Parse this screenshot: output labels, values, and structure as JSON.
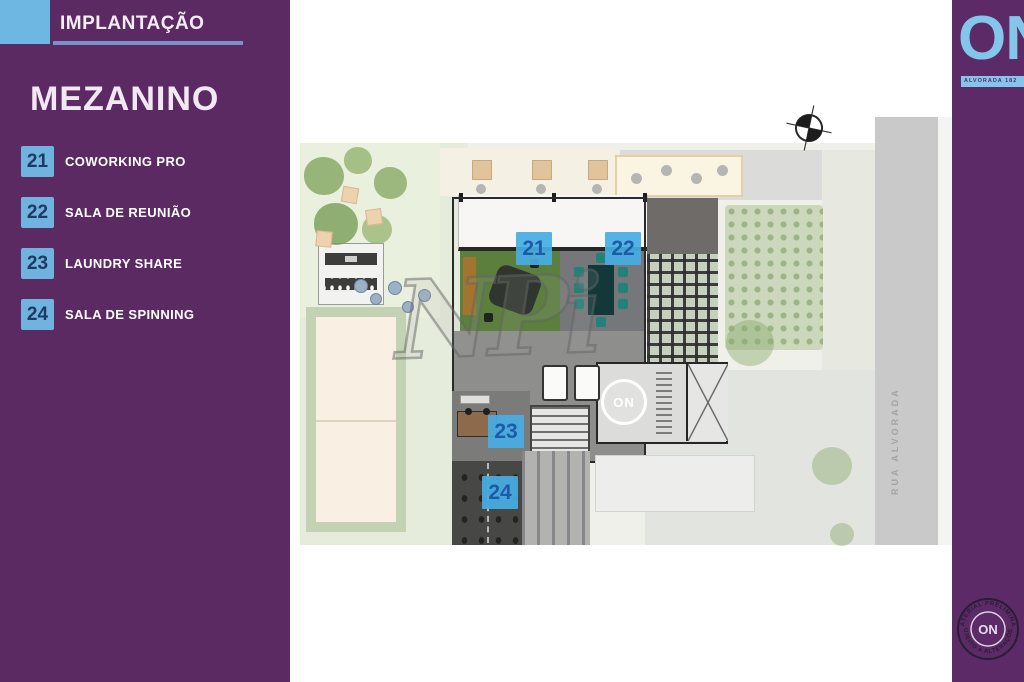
{
  "slide": {
    "header_tag": "IMPLANTAÇÃO",
    "title": "MEZANINO"
  },
  "legend": {
    "items": [
      {
        "num": "21",
        "label": "COWORKING PRO"
      },
      {
        "num": "22",
        "label": "SALA DE REUNIÃO"
      },
      {
        "num": "23",
        "label": "LAUNDRY SHARE"
      },
      {
        "num": "24",
        "label": "SALA DE SPINNING"
      }
    ]
  },
  "plan": {
    "street_label": "RUA ALVORADA",
    "watermark": "NPi",
    "floor_logo_text": "ON",
    "markers": [
      {
        "num": "21"
      },
      {
        "num": "22"
      },
      {
        "num": "23"
      },
      {
        "num": "24"
      }
    ]
  },
  "brand": {
    "logo_text": "ON",
    "logo_tagline": "ALVORADA 182",
    "stamp_center_text": "ON",
    "stamp_arc_top": "MATERIAL PRELIMINAR",
    "stamp_arc_bottom": "SUJEITO A ALTERAÇÕES"
  },
  "colors": {
    "sidebar_purple": "#5b2a62",
    "right_strip_purple": "#5c2a66",
    "accent_light_blue": "#6fb3de",
    "header_underline_blue": "#7b90c6",
    "marker_background": "#47ade3",
    "marker_number": "#1c5ba8"
  }
}
